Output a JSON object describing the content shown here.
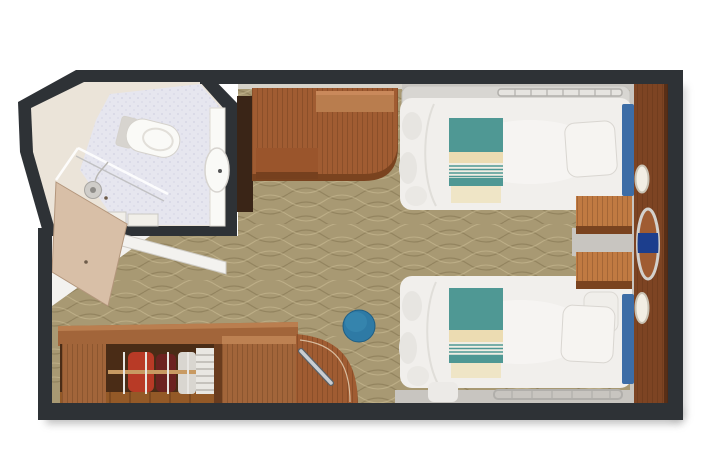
{
  "scene": {
    "type": "cruise-stateroom-floorplan-3d-top-view",
    "rooms": [
      "bathroom",
      "entry-vestibule",
      "main-cabin"
    ],
    "furniture": [
      "toilet",
      "washbasin",
      "shower-enclosure",
      "bathroom-door",
      "entry-door",
      "wardrobe-with-hanging-clothes",
      "towel-shelves",
      "drawer-cabinet",
      "curved-corner-cabinet",
      "desk-unit",
      "vanity-stool",
      "twin-bed-upper",
      "twin-bed-lower",
      "bed-runner-upper",
      "bed-runner-lower",
      "pillows",
      "nightstand-upper",
      "nightstand-lower",
      "vanity-wall-panel",
      "reading-lamp-upper",
      "reading-lamp-lower",
      "vanity-oval-with-seat",
      "patterned-carpet"
    ]
  },
  "colors": {
    "background": "#ffffff",
    "wall": "#2e3236",
    "shadow": "#8f8f8f",
    "carpet_base": "#a89973",
    "carpet_dark": "#7e6f4c",
    "carpet_light": "#cdbf97",
    "gray_floor": "#c8c5c0",
    "entry_floor": "#f3f2ef",
    "wall_ledge": "#d6d2c9",
    "bathroom_wall": "#ebe4d9",
    "bathroom_floor": "#e6e6ef",
    "fixture_white": "#fafaf7",
    "fixture_shadow": "#d7d4cf",
    "counter_dark": "#3a2517",
    "wood_desk": "#a05c32",
    "wood_light": "#b97d4e",
    "wood_dark": "#7a431f",
    "wood_panel": "#7d4423",
    "wood_nightstand": "#ad5f2d",
    "wood_nightstand_top": "#c07a42",
    "wood_cabinet": "#a2653a",
    "closet_interior": "#4a2c16",
    "closet_floor": "#935927",
    "hanger_rod": "#c89a62",
    "door_beige": "#d8bfa7",
    "door_edge": "#b3967c",
    "bed_white": "#f1efec",
    "bed_shade": "#dcdad5",
    "sofa_gray": "#d8d6d2",
    "rail_gray": "#b1afab",
    "runner_teal": "#4f9894",
    "runner_cream": "#ecdcb2",
    "runner_tail": "#efe5c6",
    "stripe_bg": "#f1eee4",
    "headboard_blue": "#3d6da6",
    "stool_blue": "#2e7aa5",
    "accent_navy": "#1c3e8d",
    "metal": "#c9ced3",
    "clothes_red": "#b83a26",
    "clothes_maroon": "#6c2220",
    "clothes_white": "#d9d6d0",
    "towel": "#e9e7e2",
    "glass": "#ffffff"
  }
}
